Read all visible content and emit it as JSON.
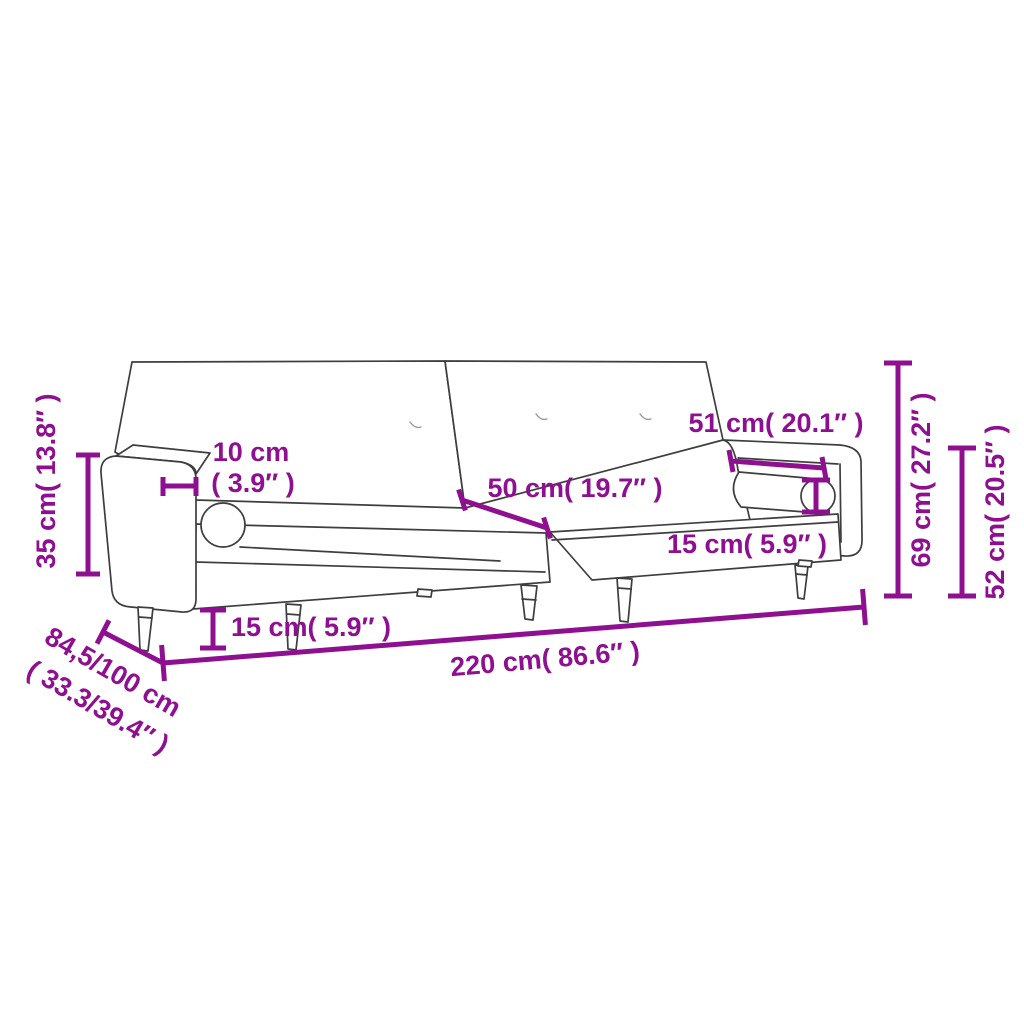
{
  "diagram": {
    "type": "furniture-dimension-diagram",
    "subject": "sofa-bed-line-drawing",
    "colors": {
      "dimension_annotation": "#8E1090",
      "drawing_outline": "#3E3E3E",
      "background": "#FFFFFF"
    },
    "dimensions": {
      "armrest_height": {
        "label": "35 cm( 13.8″ )",
        "value_cm": 35,
        "value_in": 13.8
      },
      "armrest_width_cm": {
        "label": "10 cm",
        "value_cm": 10
      },
      "armrest_width_in": {
        "label": "( 3.9″ )",
        "value_in": 3.9
      },
      "backrest_section_width": {
        "label": "50 cm( 19.7″ )",
        "value_cm": 50,
        "value_in": 19.7
      },
      "armrest_length": {
        "label": "51 cm( 20.1″ )",
        "value_cm": 51,
        "value_in": 20.1
      },
      "bolster_diameter": {
        "label": "15 cm( 5.9″ )",
        "value_cm": 15,
        "value_in": 5.9
      },
      "leg_height": {
        "label": "15 cm( 5.9″ )",
        "value_cm": 15,
        "value_in": 5.9
      },
      "total_width": {
        "label": "220 cm( 86.6″ )",
        "value_cm": 220,
        "value_in": 86.6
      },
      "total_height": {
        "label": "69 cm( 27.2″ )",
        "value_cm": 69,
        "value_in": 27.2
      },
      "seat_back_height": {
        "label": "52 cm( 20.5″ )",
        "value_cm": 52,
        "value_in": 20.5
      },
      "depth_cm": {
        "label": "84,5/100 cm"
      },
      "depth_in": {
        "label": "( 33.3/39.4″ )"
      }
    }
  }
}
